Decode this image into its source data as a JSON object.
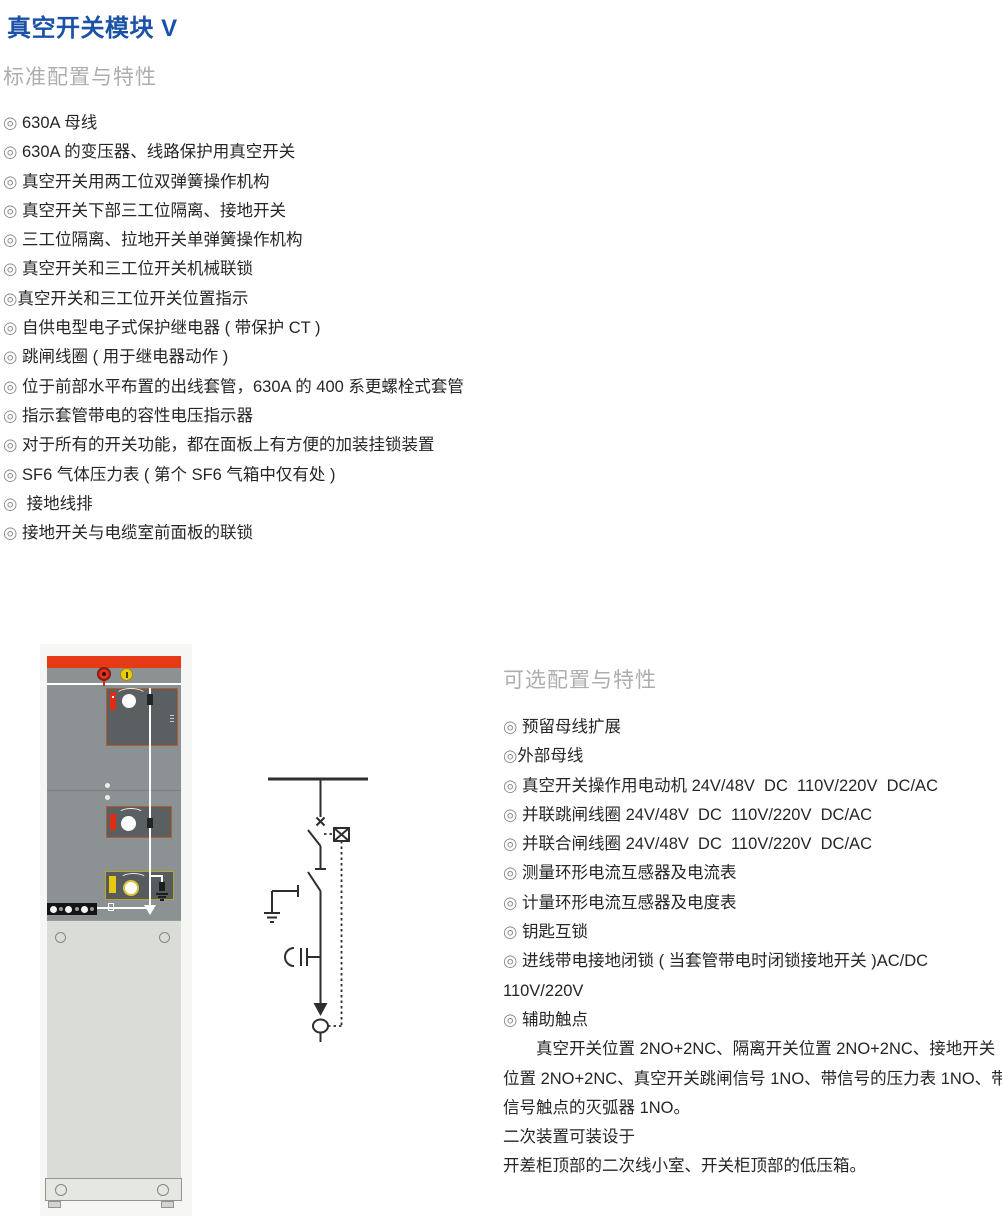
{
  "page": {
    "title": "真空开关模块 V"
  },
  "colors": {
    "title_blue": "#1b52a8",
    "heading_gray": "#aeaeae",
    "cabinet_red_band": "#e63a17",
    "cabinet_body_gray": "#8c9194",
    "panel_dark": "#5a6062",
    "strip_red": "#e02c15",
    "strip_yellow": "#e7c70f",
    "diagram_ink": "#2e2e2e"
  },
  "icons": {
    "bullet": "double-circle-bullet ◎",
    "cabinet": "switchgear-cabinet-front-photo",
    "diagram": "single-line-circuit-diagram"
  },
  "standard": {
    "heading": "标准配置与特性",
    "items": [
      {
        "bullet": "◎",
        "text": " 630A 母线"
      },
      {
        "bullet": "◎",
        "text": " 630A 的变压器、线路保护用真空开关"
      },
      {
        "bullet": "◎",
        "text": " 真空开关用两工位双弹簧操作机构"
      },
      {
        "bullet": "◎",
        "text": " 真空开关下部三工位隔离、接地开关"
      },
      {
        "bullet": "◎",
        "text": " 三工位隔离、拉地开关单弹簧操作机构"
      },
      {
        "bullet": "◎",
        "text": " 真空开关和三工位开关机械联锁"
      },
      {
        "bullet": "◎",
        "text": "真空开关和三工位开关位置指示"
      },
      {
        "bullet": "◎",
        "text": " 自供电型电子式保护继电器 ( 带保护 CT )"
      },
      {
        "bullet": "◎",
        "text": " 跳闸线圈 ( 用于继电器动作 )"
      },
      {
        "bullet": "◎",
        "text": " 位于前部水平布置的出线套管，630A 的 400 系更螺栓式套管"
      },
      {
        "bullet": "◎",
        "text": " 指示套管带电的容性电压指示器"
      },
      {
        "bullet": "◎",
        "text": " 对于所有的开关功能，都在面板上有方便的加装挂锁装置"
      },
      {
        "bullet": "◎",
        "text": " SF6 气体压力表 ( 第个 SF6 气箱中仅有处 )"
      },
      {
        "bullet": "◎",
        "text": "  接地线排"
      },
      {
        "bullet": "◎",
        "text": " 接地开关与电缆室前面板的联锁"
      }
    ]
  },
  "optional": {
    "heading": "可选配置与特性",
    "items": [
      {
        "bullet": "◎",
        "text": " 预留母线扩展"
      },
      {
        "bullet": "◎",
        "text": "外部母线"
      },
      {
        "bullet": "◎",
        "text": " 真空开关操作用电动机 24V/48V  DC  110V/220V  DC/AC"
      },
      {
        "bullet": "◎",
        "text": " 并联跳闸线圈 24V/48V  DC  110V/220V  DC/AC"
      },
      {
        "bullet": "◎",
        "text": " 并联合闸线圈 24V/48V  DC  110V/220V  DC/AC"
      },
      {
        "bullet": "◎",
        "text": " 测量环形电流互感器及电流表"
      },
      {
        "bullet": "◎",
        "text": " 计量环形电流互感器及电度表"
      },
      {
        "bullet": "◎",
        "text": " 钥匙互锁"
      },
      {
        "bullet": "◎",
        "text": " 进线带电接地闭锁 ( 当套管带电时闭锁接地开关 )AC/DC\n110V/220V"
      },
      {
        "bullet": "◎",
        "text": " 辅助触点"
      }
    ],
    "paragraphs": [
      "真空开关位置 2NO+2NC、隔离开关位置 2NO+2NC、接地开关\n位置 2NO+2NC、真空开关跳闸信号 1NO、带信号的压力表 1NO、带\n信号触点的灭弧器 1NO。",
      "二次装置可装设于",
      "开差柜顶部的二次线小室、开关柜顶部的低压箱。"
    ]
  }
}
